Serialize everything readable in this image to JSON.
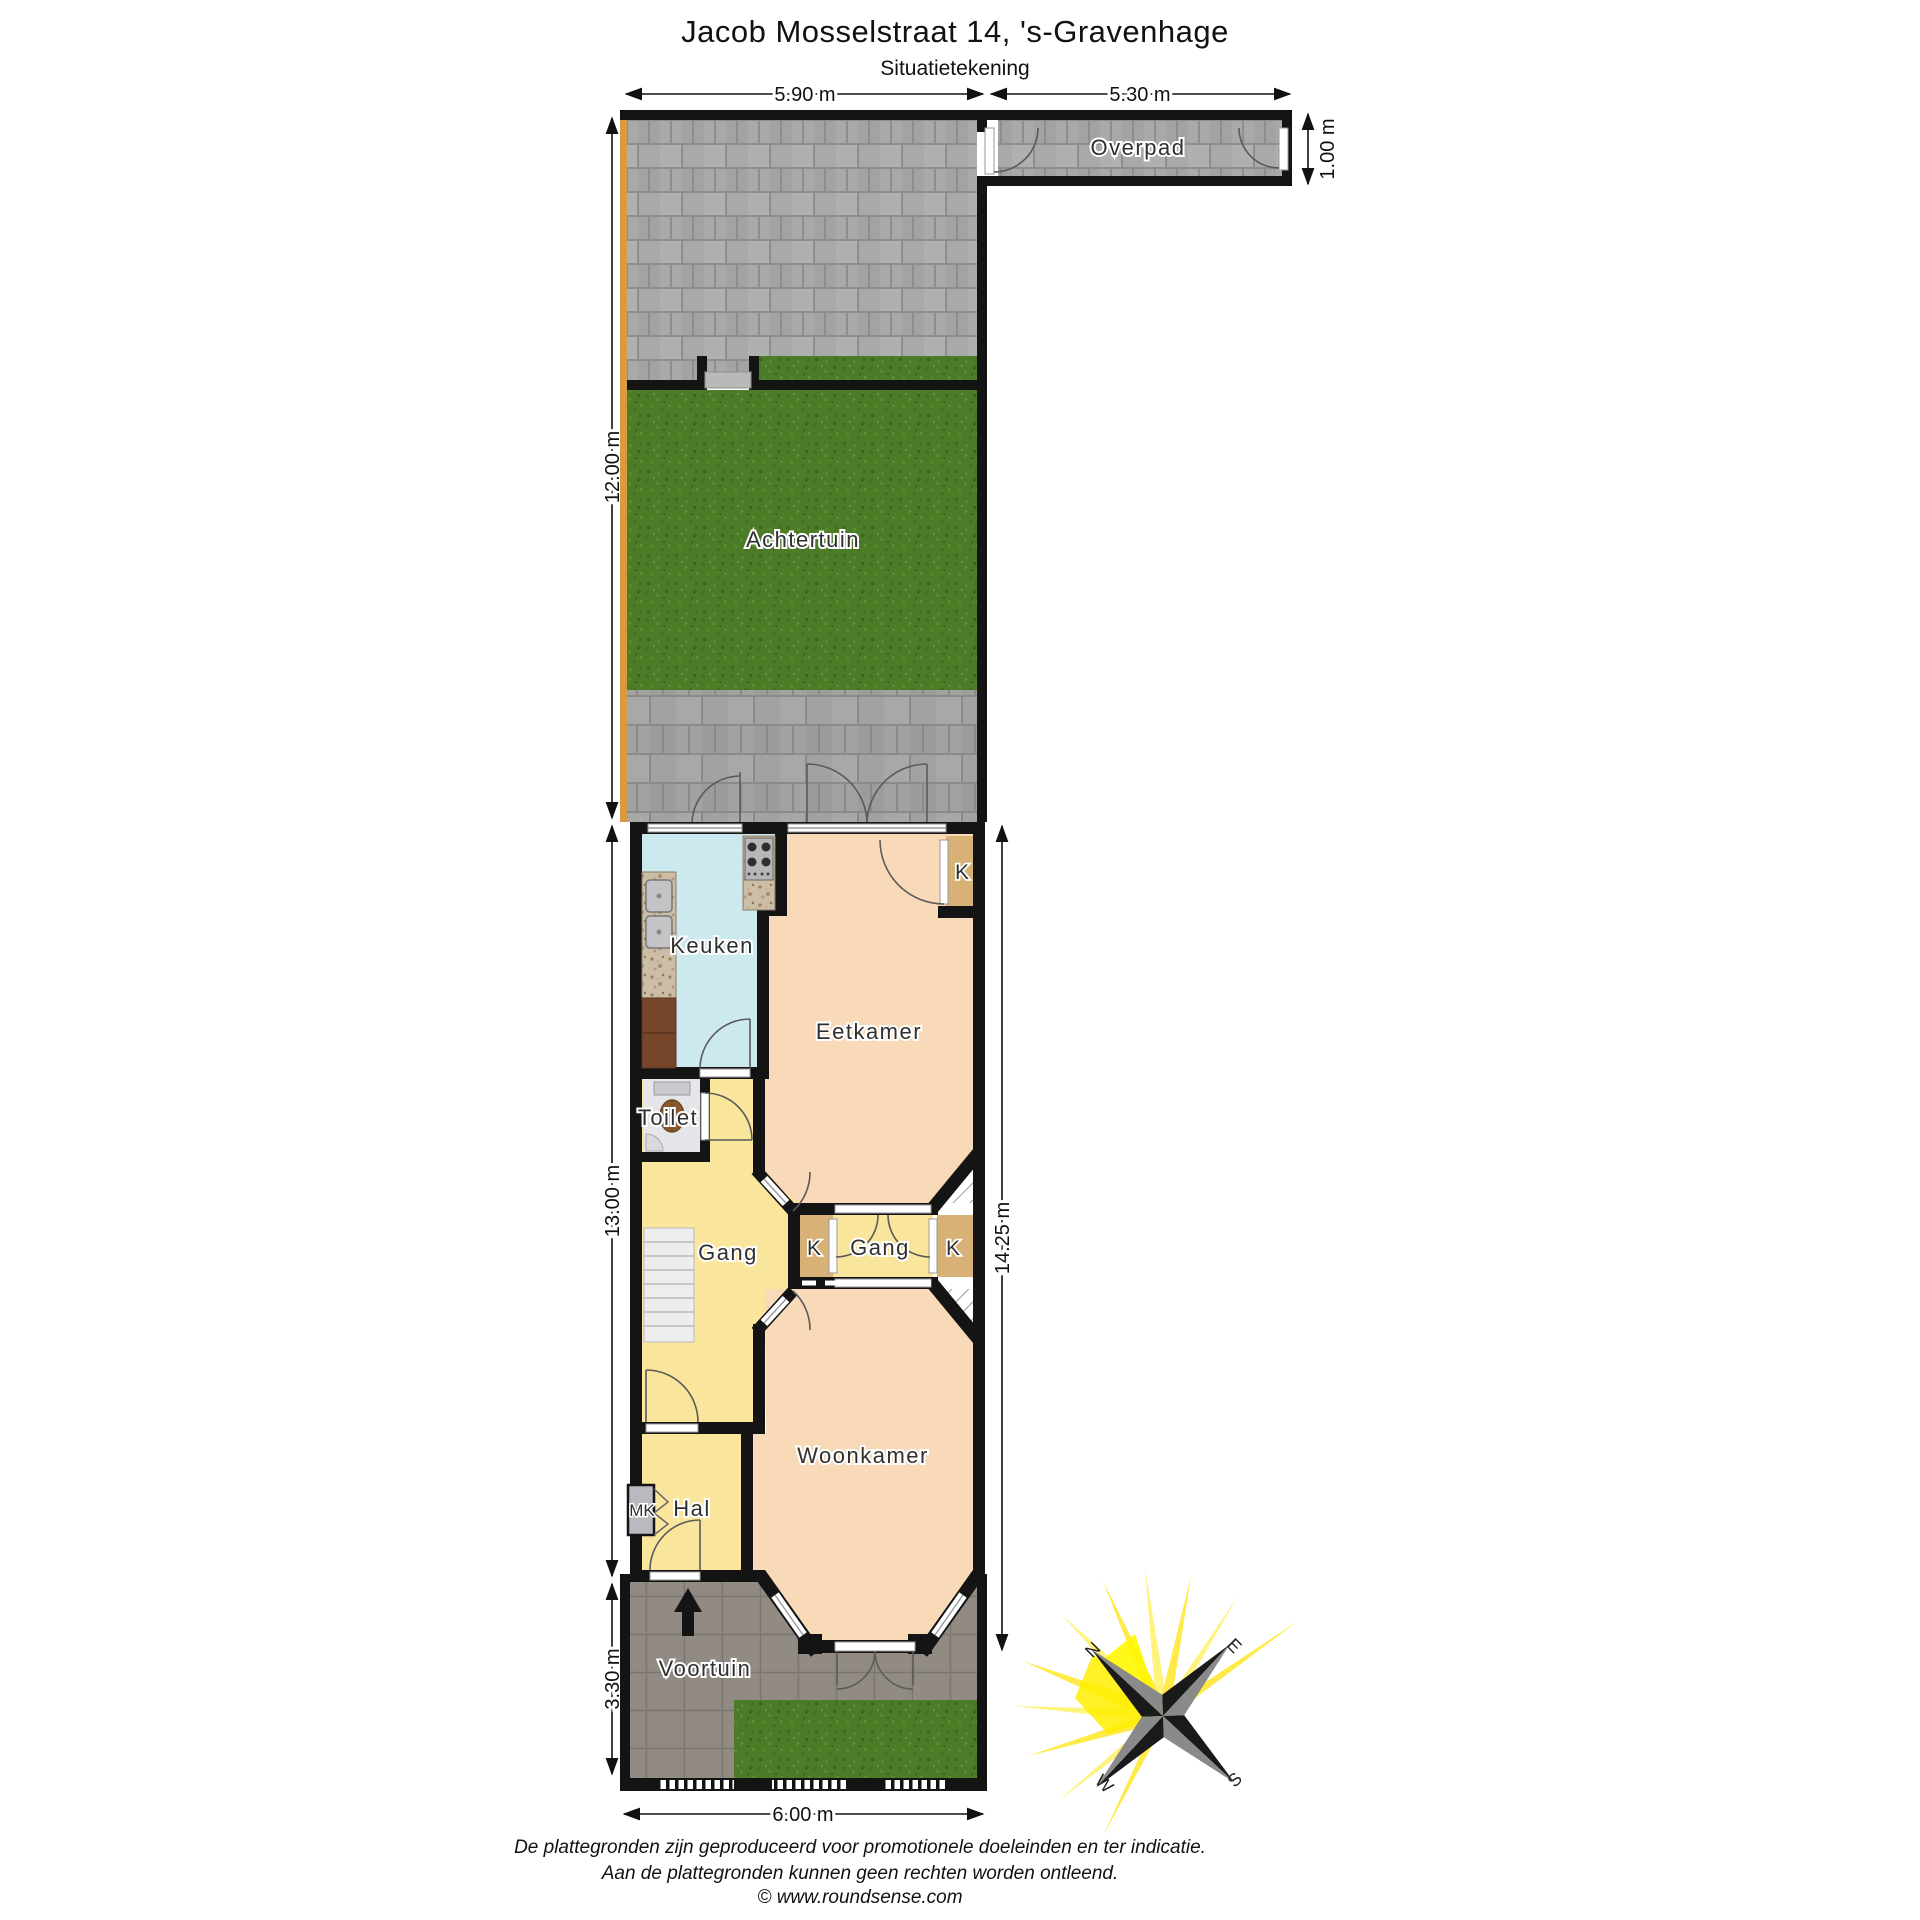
{
  "title": "Jacob Mosselstraat 14, 's-Gravenhage",
  "subtitle": "Situatietekening",
  "dims": {
    "back_width_left": "5.90 m",
    "back_width_right": "5.30 m",
    "overpad_depth": "1.00 m",
    "back_garden_depth": "12.00 m",
    "house_depth_left": "13.00 m",
    "house_depth_right": "14.25 m",
    "front_garden_depth": "3.30 m",
    "front_width": "6.00 m"
  },
  "rooms": {
    "overpad": "Overpad",
    "achtertuin": "Achtertuin",
    "keuken": "Keuken",
    "eetkamer": "Eetkamer",
    "closet_eetkamer": "K",
    "toilet": "Toilet",
    "gang": "Gang",
    "closet_left": "K",
    "gang_middle": "Gang",
    "closet_right": "K",
    "woonkamer": "Woonkamer",
    "mk": "MK",
    "hal": "Hal",
    "voortuin": "Voortuin"
  },
  "compass": {
    "north": "N",
    "east": "E",
    "south": "S",
    "west": "W"
  },
  "footer": {
    "line1": "De plattegronden zijn geproduceerd voor promotionele doeleinden en ter indicatie.",
    "line2": "Aan de plattegronden kunnen geen rechten worden ontleend.",
    "line3": "© www.roundsense.com"
  },
  "colors": {
    "wall": "#141414",
    "paving": "#a9a9a7",
    "terrace_paving": "#a0a09e",
    "grass": "#4d7c28",
    "front_paving": "#8d8781",
    "keuken_floor": "#cde9f0",
    "living_floor": "#f8dab8",
    "hall_floor": "#fae59c",
    "closet_floor": "#d7b176",
    "toilet_floor": "#e6e6ea",
    "garden_fence": "#d89b3f",
    "compass_ray": "#ffe93d"
  }
}
